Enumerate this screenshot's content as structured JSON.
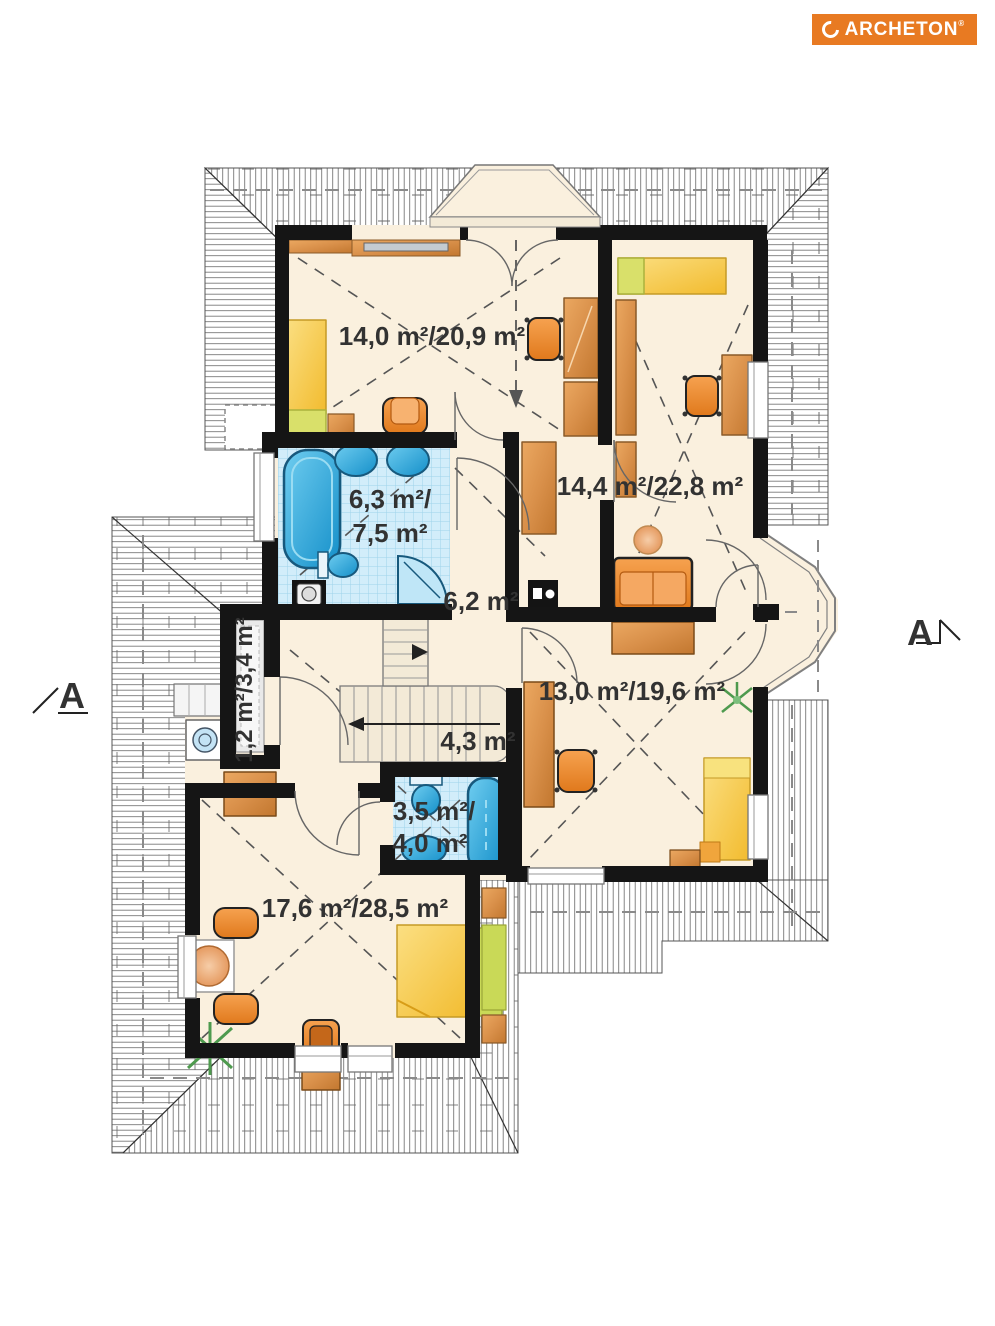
{
  "brand": {
    "name": "ARCHETON",
    "registered": "®",
    "color": "#e87a22"
  },
  "section": {
    "left_label": "A",
    "right_label": "A"
  },
  "rooms": {
    "bedroom_top_left": {
      "label": "14,0 m²/20,9 m²"
    },
    "bedroom_top_right": {
      "label": "14,4 m²/22,8 m²"
    },
    "bathroom": {
      "line1": "6,3 m²/",
      "line2": "7,5 m²"
    },
    "hall": {
      "label": "6,2 m²"
    },
    "room_middle_right": {
      "label": "13,0 m²/19,6 m²"
    },
    "utility": {
      "label": "1,2 m²/3,4 m²"
    },
    "stairs": {
      "label": "4,3 m²"
    },
    "bathroom_small": {
      "line1": "3,5 m²/",
      "line2": "4,0 m²"
    },
    "bedroom_bottom_left": {
      "label": "17,6 m²/28,5 m²"
    }
  }
}
